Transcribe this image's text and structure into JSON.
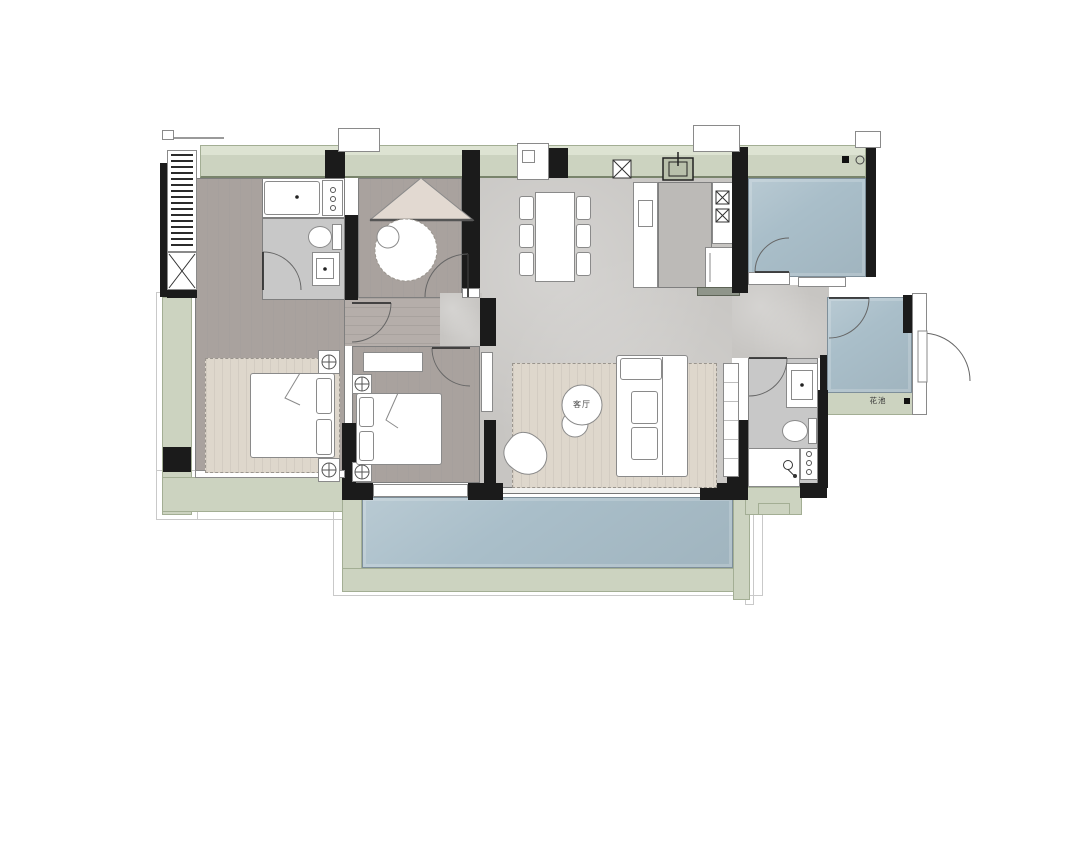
{
  "labels": {
    "living_room": "客厅",
    "flower_bed": "花池"
  },
  "colors": {
    "wall": "#1b1b1b",
    "wood": "#a9a29e",
    "wood2": "#b5aeaa",
    "marble": "#c7c5c2",
    "marble-dark": "#bcbab7",
    "tile": "#a9bec9",
    "green": "#ccd3c0",
    "green-dark": "#a3ae94",
    "bath": "#c8c8c8",
    "rug": "#ded7cc",
    "tent": "#e2d9d1",
    "white": "#ffffff"
  }
}
